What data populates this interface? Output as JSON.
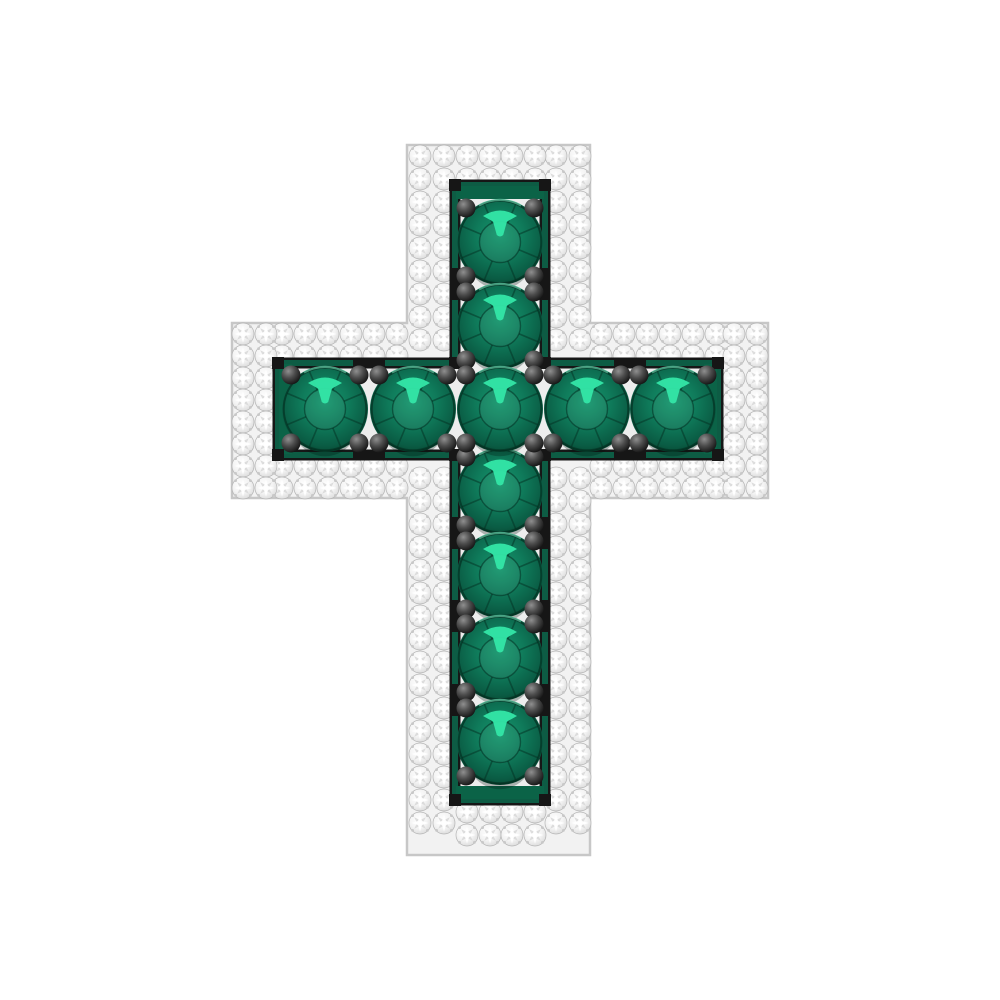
{
  "scene": {
    "type": "jewelry-product-render",
    "subject": "emerald-and-diamond-cross-pendant",
    "background_color": "#ffffff"
  },
  "palette": {
    "metal_base": "#f2f2f2",
    "metal_edge": "#c7c7c7",
    "pave_diamond_edge": "#bfbfbf",
    "pave_diamond_sparkle": "#ffffff",
    "pave_diamond_facet": "#d9d9d9",
    "emerald_light": "#17976e",
    "emerald_mid": "#0f7a5a",
    "emerald_dark": "#0a5c44",
    "emerald_rim": "#07452f",
    "emerald_highlight": "#33e5a7",
    "channel_green": "#0d5c44",
    "channel_cap_green": "#0b6347",
    "channel_black": "#161616",
    "channel_floor": "#ededed",
    "prong_light": "#8f8f8f",
    "prong_dark": "#0b0b0b"
  },
  "counts": {
    "emeralds": 11,
    "pave_diamonds": 196,
    "prongs": 44
  },
  "geometry": {
    "canvas": {
      "width": 1000,
      "height": 1000
    },
    "cross": {
      "vertical_bar": {
        "x": 407,
        "y": 145,
        "width": 183,
        "height": 710
      },
      "horizontal_bar": {
        "x": 232,
        "y": 323,
        "width": 536,
        "height": 175
      }
    },
    "channel": {
      "vertical": {
        "x": 455,
        "y": 185,
        "width": 90,
        "height": 615
      },
      "horizontal": {
        "x": 278,
        "y": 363,
        "width": 440,
        "height": 92
      },
      "wall_thickness": 6,
      "end_cap_thickness": 13
    },
    "emeralds": {
      "radius": 43,
      "positions": [
        [
          500,
          242
        ],
        [
          500,
          326
        ],
        [
          325,
          409
        ],
        [
          413,
          409
        ],
        [
          587,
          409
        ],
        [
          673,
          409
        ],
        [
          500,
          491
        ],
        [
          500,
          575
        ],
        [
          500,
          658
        ],
        [
          500,
          742
        ],
        [
          500,
          409
        ]
      ]
    },
    "prongs": {
      "radius": 9.5,
      "offset": 34
    },
    "hardware": {
      "horizontal_junctions_x": [
        369,
        630
      ],
      "vertical_junctions_y": [
        284,
        533,
        616,
        700
      ],
      "tick_size": [
        32,
        11
      ],
      "corner_size": 12
    },
    "pave": {
      "radius": 11,
      "pitch": 23,
      "runs": [
        {
          "name": "vertical-left-band",
          "cols": [
            420,
            444
          ],
          "rows": [
            156,
            179,
            202,
            225,
            248,
            271,
            294,
            317,
            340,
            478,
            501,
            524,
            547,
            570,
            593,
            616,
            639,
            662,
            685,
            708,
            731,
            754,
            777,
            800,
            823
          ]
        },
        {
          "name": "vertical-right-band",
          "cols": [
            556,
            580
          ],
          "rows": [
            156,
            179,
            202,
            225,
            248,
            271,
            294,
            317,
            340,
            478,
            501,
            524,
            547,
            570,
            593,
            616,
            639,
            662,
            685,
            708,
            731,
            754,
            777,
            800,
            823
          ]
        },
        {
          "name": "vertical-top-cap",
          "cols": [
            467,
            490,
            512,
            535
          ],
          "rows": [
            156,
            179
          ]
        },
        {
          "name": "vertical-bottom-cap",
          "cols": [
            467,
            490,
            512,
            535
          ],
          "rows": [
            812,
            835
          ]
        },
        {
          "name": "crossbar-top-band",
          "cols": [
            282,
            305,
            328,
            351,
            374,
            397,
            601,
            624,
            647,
            670,
            693,
            716
          ],
          "rows": [
            334,
            356
          ]
        },
        {
          "name": "crossbar-bottom-band",
          "cols": [
            282,
            305,
            328,
            351,
            374,
            397,
            601,
            624,
            647,
            670,
            693,
            716
          ],
          "rows": [
            466,
            488
          ]
        },
        {
          "name": "crossbar-left-cap",
          "cols": [
            243,
            266
          ],
          "rows": [
            334,
            356,
            378,
            400,
            422,
            444,
            466,
            488
          ]
        },
        {
          "name": "crossbar-right-cap",
          "cols": [
            734,
            757
          ],
          "rows": [
            334,
            356,
            378,
            400,
            422,
            444,
            466,
            488
          ]
        }
      ]
    }
  }
}
